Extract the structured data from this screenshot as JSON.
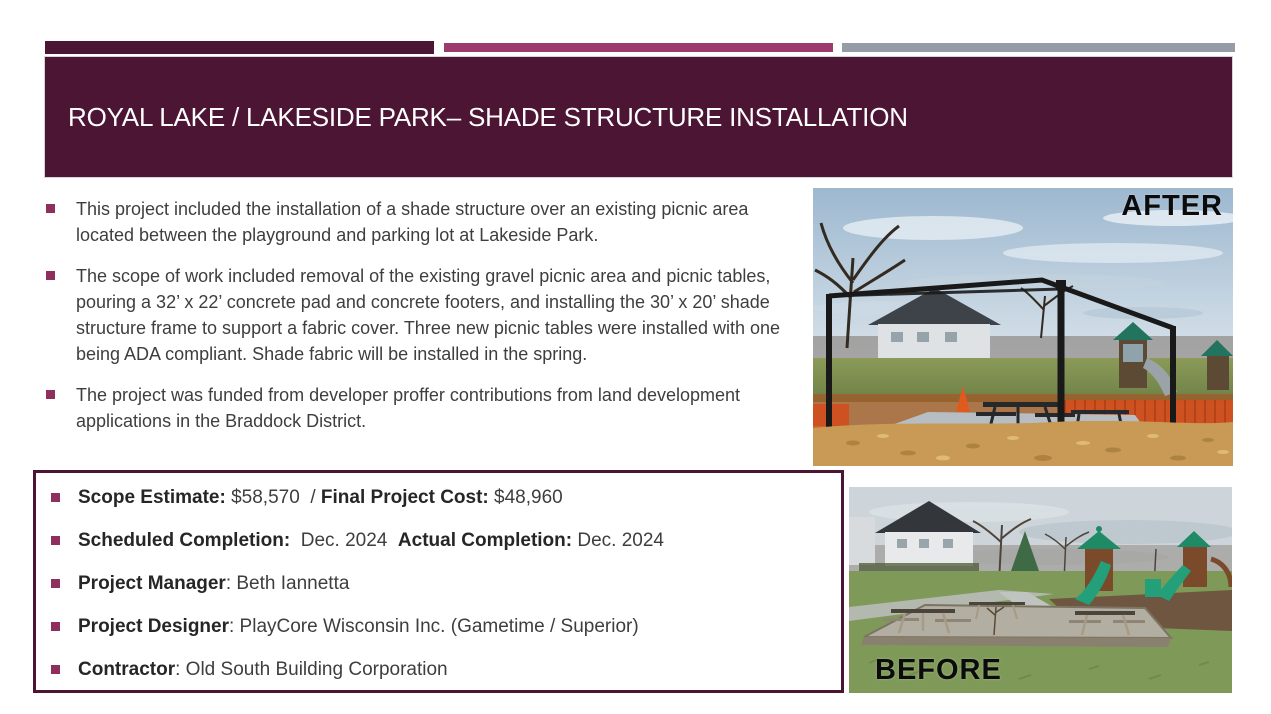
{
  "slide": {
    "title": "ROYAL LAKE / LAKESIDE PARK– SHADE STRUCTURE INSTALLATION"
  },
  "bullets": [
    "This project included the installation of a shade structure over an existing picnic area located between the playground and parking lot at Lakeside Park.",
    "The scope of work included removal of the existing gravel picnic area and picnic tables, pouring a 32’ x 22’ concrete pad and concrete footers, and installing the 30’ x 20’ shade structure frame to support a fabric cover.  Three new picnic tables were installed with one being ADA compliant. Shade fabric will be installed in the spring.",
    "The project was funded from developer proffer contributions from land development applications in the Braddock District."
  ],
  "details_box": {
    "rows": [
      {
        "segments": [
          {
            "t": "Scope Estimate:",
            "b": true
          },
          {
            "t": " $58,570  / ",
            "b": false
          },
          {
            "t": "Final Project Cost:",
            "b": true
          },
          {
            "t": " $48,960",
            "b": false
          }
        ]
      },
      {
        "segments": [
          {
            "t": "Scheduled Completion:",
            "b": true
          },
          {
            "t": "  Dec. 2024  ",
            "b": false
          },
          {
            "t": "Actual Completion:",
            "b": true
          },
          {
            "t": " Dec. 2024",
            "b": false
          }
        ]
      },
      {
        "segments": [
          {
            "t": "Project Manager",
            "b": true
          },
          {
            "t": ": Beth Iannetta",
            "b": false
          }
        ]
      },
      {
        "segments": [
          {
            "t": "Project Designer",
            "b": true
          },
          {
            "t": ": PlayCore Wisconsin Inc. (Gametime / Superior)",
            "b": false
          }
        ]
      },
      {
        "segments": [
          {
            "t": "Contractor",
            "b": true
          },
          {
            "t": ": Old South Building Corporation",
            "b": false
          }
        ]
      }
    ]
  },
  "photos": {
    "after_label": "AFTER",
    "before_label": "BEFORE"
  },
  "colors": {
    "plum": "#4D1534",
    "bar-magenta": "#9C3A6D",
    "bar-gray": "#949CA5",
    "bullet": "#8E2F5D",
    "text": "#3E3E3E",
    "bold-text": "#262626"
  }
}
